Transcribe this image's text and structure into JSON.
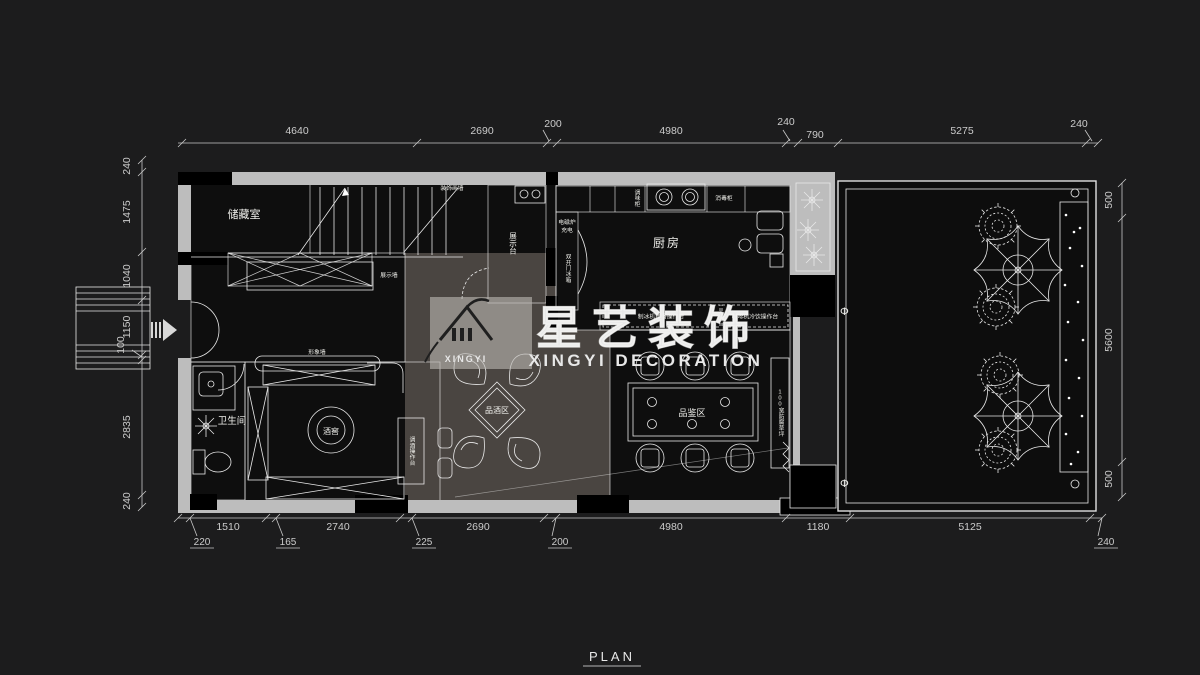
{
  "title": {
    "plan": "PLAN"
  },
  "watermark": {
    "logo": "XINGYI",
    "cn": "星艺装饰",
    "en": "XINGYI DECORATION"
  },
  "rooms": {
    "storage": "储藏室",
    "kitchen": "厨房",
    "bathroom": "卫生间",
    "wine_cellar": "酒窖",
    "tasting": "品酒区",
    "sampling": "品鉴区"
  },
  "labels": {
    "display_counter": "展示台",
    "display_wall": "展示墙",
    "image_wall": "形象墙",
    "bar_counter": "调酒操作台",
    "deco_wall": "装饰画墙",
    "lawn": "100宽防腐草坪",
    "phi": "Φ"
  },
  "kitchen": {
    "spice": "调味柜",
    "sterilizer": "消毒柜",
    "induction1": "电磁炉",
    "induction2": "充电",
    "fridge": "双开门冰箱",
    "counter_left": "制冰机西餐操作台",
    "counter_right": "咖啡机冷饮操作台"
  },
  "dims": {
    "top": [
      "4640",
      "2690",
      "200",
      "4980",
      "240",
      "790",
      "5275",
      "240"
    ],
    "left": [
      "240",
      "1475",
      "1040",
      "1150",
      "100",
      "2835",
      "240"
    ],
    "right": [
      "500",
      "5600",
      "500"
    ],
    "bottom": [
      "1510",
      "2740",
      "2690",
      "4980",
      "1180",
      "5125"
    ],
    "bottom_sub": [
      "220",
      "165",
      "225",
      "200",
      "240"
    ]
  },
  "colors": {
    "bg": "#1c1c1d",
    "wall": "#bdbdbd",
    "dimline": "#c9c9c9",
    "base": "#0e0e0e",
    "reception": "#7b4a2b",
    "display_cab": "#8a5731",
    "cellar": "#61361e",
    "sampling": "#6f2f18",
    "tasting": "#4a4541",
    "kitchen_floor": "#7c756a",
    "corridor": "#8a847a",
    "counter": "#8f897c",
    "bathroom": "#2c3037",
    "terrace": "#0d0d0d"
  }
}
